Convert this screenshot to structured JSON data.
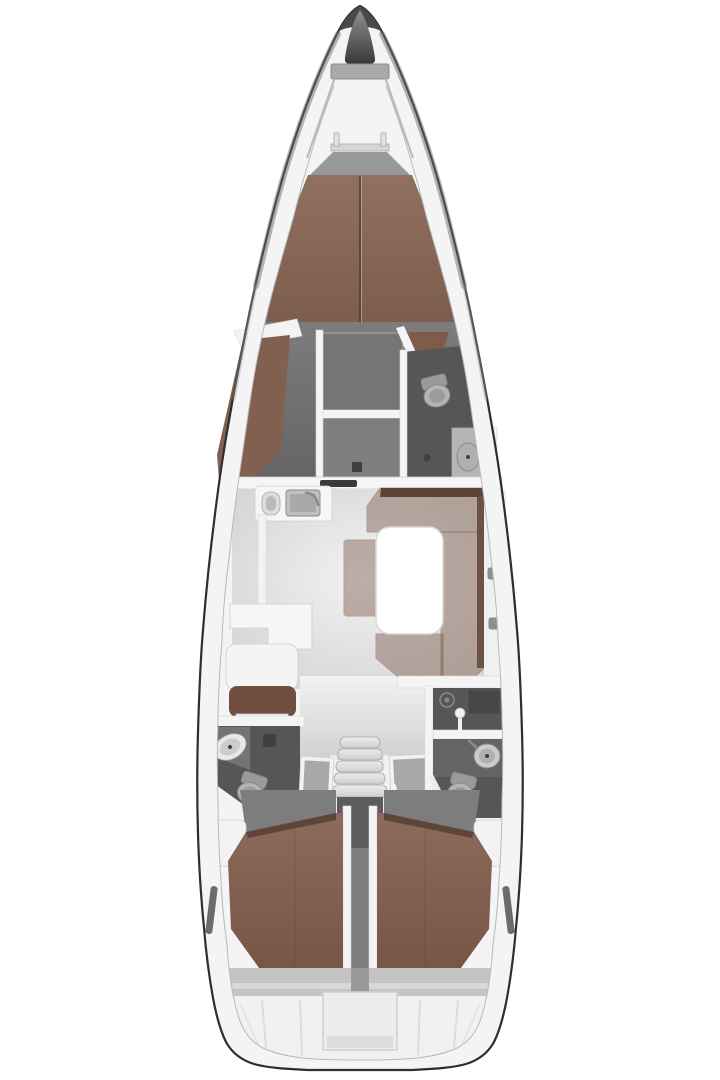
{
  "canvas": {
    "width": 720,
    "height": 1080,
    "background": "#ffffff"
  },
  "colors": {
    "hull_outline": "#2e2e2e",
    "deck_ring": "#f4f4f4",
    "bow_cap_dark": "#4a4a4a",
    "anchor_top": "#919191",
    "anchor_bottom": "#383838",
    "bow_shelf": "#a9a9a9",
    "rail_gray": "#d6d6d6",
    "rail_post": "#e3e3e3",
    "berth_head_gray": "#989898",
    "vberth_top": "#927060",
    "vberth_bottom": "#7c5c4c",
    "berth_center_line": "#4e3c32",
    "fwd_floor_top": "#7c7c7c",
    "fwd_floor_bottom": "#646464",
    "settee_brown": "#82604f",
    "corner_wedge_brown": "#7d5c4b",
    "shelf_white": "#f3f3f3",
    "wardrobe_gray": "#757575",
    "wardrobe_lower": "#7e7e7e",
    "head_dark": "#565656",
    "head_mid": "#646464",
    "shower_dark": "#474747",
    "toilet_bowl": "#b4b4b4",
    "toilet_tank": "#9a9a9a",
    "toilet_inner": "#9c9c9c",
    "basin_light": "#cccccc",
    "basin_inner": "#b0b0b0",
    "basin_white": "#e8e8e8",
    "drain_dark": "#3f3f3f",
    "sink_cab": "#b5b5b5",
    "sink_cab_dark": "#747474",
    "wall_white": "#f4f4f4",
    "bulkhead_white": "#f5f5f5",
    "door_slot_dark": "#3a3a3a",
    "counter_white": "#f6f6f6",
    "sink_steel": "#c0c0c0",
    "sink_steel_inner": "#a9a9a9",
    "basin_pill": "#b9b9b9",
    "basin_pill_outer": "#dcdcdc",
    "salon_floor_light": "#f2f2f2",
    "salon_floor_dark": "#d0d0d0",
    "table_white": "#ffffff",
    "sofa_brown": "#7d5b4b",
    "sofa_back_dark": "#5f4337",
    "bench_brown": "#7d5b4b",
    "navseat_white": "#f4f4f4",
    "navback_brown": "#6f4e3f",
    "shelf_item_gray": "#9a9a9a",
    "sideboard_white": "#f0f0f0",
    "side_handle_gray": "#8f8f8f",
    "center_floor": "#e4e4e4",
    "hatch_frame": "#f2f2f2",
    "hatch_top": "#a8a8a8",
    "tread_top": "#ececec",
    "tread_bottom": "#cfcfcf",
    "steps_panel": "#5c5c5c",
    "channel_gray": "#7e7e7e",
    "berth_panel_gray": "#7d7d7d",
    "aft_berth_top": "#8d6b5c",
    "aft_berth_bottom": "#775646",
    "berth_edge_dark": "#5f4539",
    "corner_block_white": "#f3f3f3",
    "stern_band": "#c4c4c2",
    "stern_band_lip": "#d8d8d6",
    "stern_channel": "#9a9a9a",
    "transom_white": "#f1f1f1",
    "recess_fill": "#ececec",
    "recess_shade": "#dcdcdc",
    "window_slit": "#6b6b6b",
    "speaker_ring": "#8a8a8a",
    "pole_white": "#f2f2f2"
  }
}
